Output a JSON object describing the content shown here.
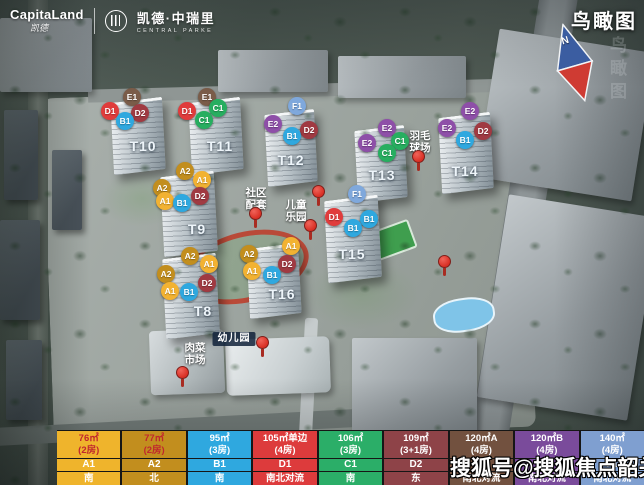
{
  "header": {
    "brand": "CapitaLand",
    "brand_script": "凯德",
    "project_name": "凯德·中瑞里",
    "project_sub": "CENTRAL PARKE"
  },
  "view_title": "鸟瞰图",
  "compass_label": "N",
  "watermark": "搜狐号@搜狐焦点韶关站",
  "map": {
    "towers": [
      {
        "label": "T8",
        "x": 203,
        "y": 311
      },
      {
        "label": "T9",
        "x": 197,
        "y": 229
      },
      {
        "label": "T10",
        "x": 143,
        "y": 146
      },
      {
        "label": "T11",
        "x": 220,
        "y": 146
      },
      {
        "label": "T12",
        "x": 291,
        "y": 160
      },
      {
        "label": "T13",
        "x": 382,
        "y": 175
      },
      {
        "label": "T14",
        "x": 465,
        "y": 171
      },
      {
        "label": "T15",
        "x": 352,
        "y": 254
      },
      {
        "label": "T16",
        "x": 282,
        "y": 294
      }
    ],
    "marker_colors": {
      "A1": "#F2B232",
      "A2": "#C28E1E",
      "B1": "#2FA8DF",
      "C1": "#27AE60",
      "D1": "#E03C3C",
      "D2": "#A03A42",
      "E1": "#7A5C49",
      "E2": "#8E4FA8",
      "F1": "#7FA8DC"
    },
    "markers": [
      {
        "t": "E1",
        "x": 132,
        "y": 97
      },
      {
        "t": "D1",
        "x": 110,
        "y": 111
      },
      {
        "t": "D2",
        "x": 140,
        "y": 113
      },
      {
        "t": "B1",
        "x": 125,
        "y": 121
      },
      {
        "t": "E1",
        "x": 207,
        "y": 97
      },
      {
        "t": "C1",
        "x": 218,
        "y": 108
      },
      {
        "t": "D1",
        "x": 187,
        "y": 111
      },
      {
        "t": "C1",
        "x": 204,
        "y": 120
      },
      {
        "t": "F1",
        "x": 297,
        "y": 106
      },
      {
        "t": "E2",
        "x": 273,
        "y": 124
      },
      {
        "t": "D2",
        "x": 309,
        "y": 130
      },
      {
        "t": "B1",
        "x": 292,
        "y": 136
      },
      {
        "t": "E2",
        "x": 387,
        "y": 128
      },
      {
        "t": "C1",
        "x": 400,
        "y": 141
      },
      {
        "t": "E2",
        "x": 367,
        "y": 143
      },
      {
        "t": "C1",
        "x": 387,
        "y": 153
      },
      {
        "t": "E2",
        "x": 470,
        "y": 111
      },
      {
        "t": "E2",
        "x": 447,
        "y": 128
      },
      {
        "t": "D2",
        "x": 483,
        "y": 131
      },
      {
        "t": "B1",
        "x": 465,
        "y": 140
      },
      {
        "t": "A2",
        "x": 185,
        "y": 171
      },
      {
        "t": "A1",
        "x": 202,
        "y": 180
      },
      {
        "t": "A2",
        "x": 162,
        "y": 188
      },
      {
        "t": "D2",
        "x": 200,
        "y": 196
      },
      {
        "t": "A1",
        "x": 165,
        "y": 201
      },
      {
        "t": "B1",
        "x": 182,
        "y": 203
      },
      {
        "t": "F1",
        "x": 357,
        "y": 194
      },
      {
        "t": "D1",
        "x": 334,
        "y": 217
      },
      {
        "t": "B1",
        "x": 369,
        "y": 219
      },
      {
        "t": "B1",
        "x": 353,
        "y": 228
      },
      {
        "t": "A1",
        "x": 291,
        "y": 246
      },
      {
        "t": "A2",
        "x": 249,
        "y": 254
      },
      {
        "t": "D2",
        "x": 287,
        "y": 264
      },
      {
        "t": "A1",
        "x": 252,
        "y": 271
      },
      {
        "t": "B1",
        "x": 272,
        "y": 275
      },
      {
        "t": "A2",
        "x": 190,
        "y": 256
      },
      {
        "t": "A1",
        "x": 209,
        "y": 264
      },
      {
        "t": "A2",
        "x": 166,
        "y": 274
      },
      {
        "t": "D2",
        "x": 207,
        "y": 283
      },
      {
        "t": "A1",
        "x": 170,
        "y": 291
      },
      {
        "t": "B1",
        "x": 189,
        "y": 292
      }
    ],
    "facility_labels": [
      {
        "text": "社区\n配套",
        "x": 256,
        "y": 188
      },
      {
        "text": "儿童\n乐园",
        "x": 296,
        "y": 200
      },
      {
        "text": "羽毛\n球场",
        "x": 420,
        "y": 131
      },
      {
        "text": "肉菜\n市场",
        "x": 195,
        "y": 343
      }
    ],
    "kindergarten_sign": {
      "text": "幼儿园"
    },
    "pins": [
      {
        "x": 418,
        "y": 150
      },
      {
        "x": 318,
        "y": 185
      },
      {
        "x": 310,
        "y": 219
      },
      {
        "x": 444,
        "y": 255
      },
      {
        "x": 255,
        "y": 207
      },
      {
        "x": 262,
        "y": 336
      },
      {
        "x": 182,
        "y": 366
      }
    ]
  },
  "legend": {
    "columns": [
      {
        "area": "76㎡",
        "rooms": "(2房)",
        "type": "A1",
        "orient": "南",
        "color": "#EFB42C",
        "area_text": "#C1272D"
      },
      {
        "area": "77㎡",
        "rooms": "(2房)",
        "type": "A2",
        "orient": "北",
        "color": "#C28E1E",
        "area_text": "#C1272D"
      },
      {
        "area": "95㎡",
        "rooms": "(3房)",
        "type": "B1",
        "orient": "南",
        "color": "#2FA8DF",
        "area_text": "#FFFFFF"
      },
      {
        "area": "105㎡单边",
        "rooms": "(4房)",
        "type": "D1",
        "orient": "南北对流",
        "color": "#DD3B3C",
        "area_text": "#FFFFFF"
      },
      {
        "area": "106㎡",
        "rooms": "(3房)",
        "type": "C1",
        "orient": "南",
        "color": "#2BAE68",
        "area_text": "#FFFFFF"
      },
      {
        "area": "109㎡",
        "rooms": "(3+1房)",
        "type": "D2",
        "orient": "东",
        "color": "#8E4348",
        "area_text": "#FFFFFF"
      },
      {
        "area": "120㎡A",
        "rooms": "(4房)",
        "type": "E1",
        "orient": "南北对流",
        "color": "#72513F",
        "area_text": "#FFFFFF"
      },
      {
        "area": "120㎡B",
        "rooms": "(4房)",
        "type": "E2",
        "orient": "南北对流",
        "color": "#7A4B9B",
        "area_text": "#FFFFFF"
      },
      {
        "area": "140㎡",
        "rooms": "(4房)",
        "type": "F1",
        "orient": "南北对流",
        "color": "#7F9FD0",
        "area_text": "#FFFFFF"
      }
    ]
  }
}
